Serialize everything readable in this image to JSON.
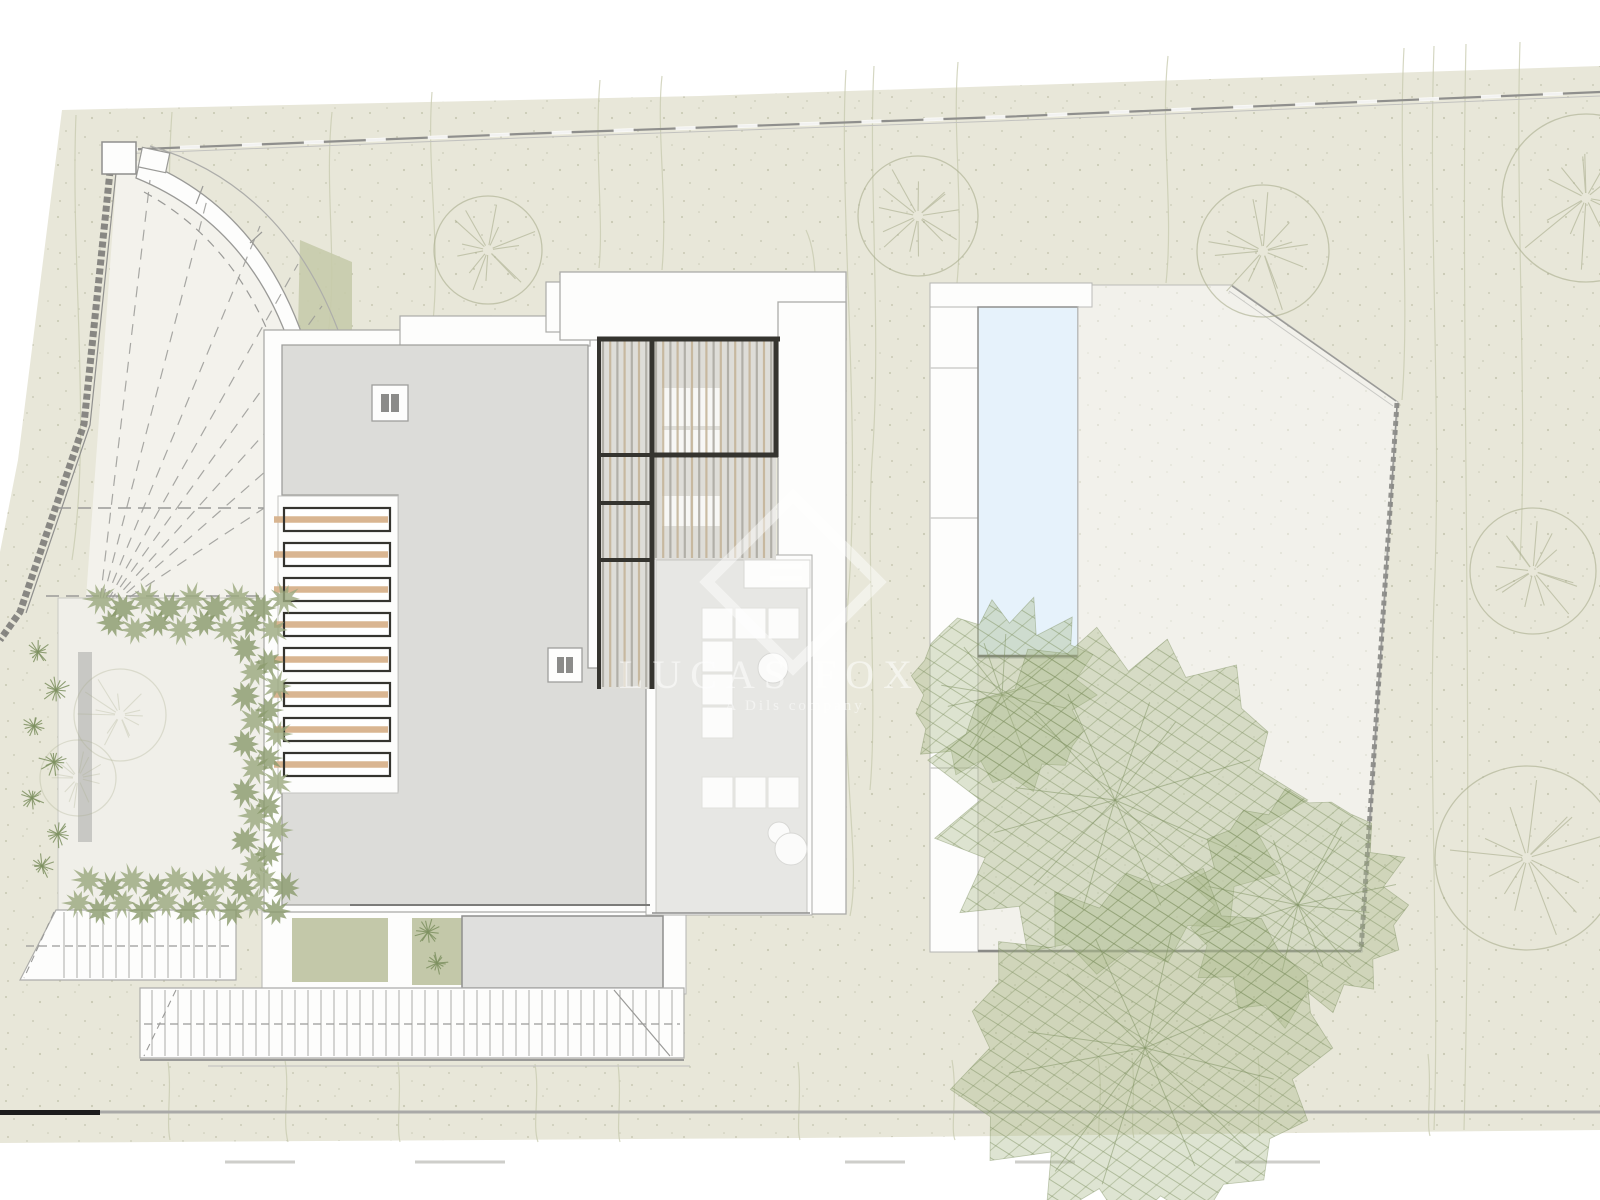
{
  "watermark": {
    "brand": "LUCAS FOX",
    "tagline": "A Dils company",
    "logo": "diamond-logo"
  },
  "colors": {
    "paper": "#ffffff",
    "ground": "#e8e7d9",
    "speckle": "#a9ac90",
    "contour": "#c7c9ae",
    "hedge": "#9aa77d",
    "hedge_dark": "#8a9a6c",
    "canopy": "#a9b789",
    "canopy_hatch": "#7e9161",
    "pool_water": "#e6f2fb",
    "roof": "#dcdcd9",
    "terrace_floor": "#e7e7e4",
    "inner_court": "#f0efe9",
    "paving": "#f2f1eb",
    "wood": "#d7b28c",
    "slat_wood": "#c3b296",
    "slat_alt": "#aaa79f",
    "slat_bg": "#deddd8",
    "frame_dark": "#35342f",
    "wall_line": "#8f8f8d",
    "boundary_black": "#1c1c1c",
    "white_built": "#fdfdfc",
    "slope_patch": "#c6cbab",
    "stair_line": "#b3b3b0"
  }
}
